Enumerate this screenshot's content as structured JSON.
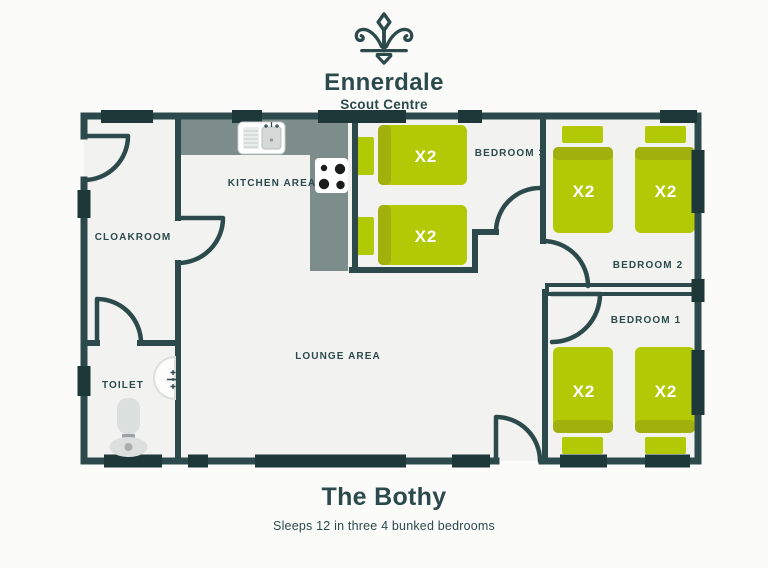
{
  "brand": {
    "name": "Ennerdale",
    "subtitle": "Scout Centre"
  },
  "plan": {
    "rooms": {
      "cloakroom": "CLOAKROOM",
      "kitchen": "KITCHEN AREA",
      "toilet": "TOILET",
      "lounge": "LOUNGE AREA",
      "bedroom3": "BEDROOM 3",
      "bedroom2": "BEDROOM 2",
      "bedroom1": "BEDROOM 1"
    },
    "bed_capacity_label": "X2",
    "colors": {
      "wall": "#2c4a4c",
      "window": "#1e3739",
      "bed": "#b2c905",
      "bed_band": "#a2b00d",
      "counter": "#7d8d8b",
      "floor": "#f2f3f0",
      "fixture": "#dbdfdd"
    }
  },
  "footer": {
    "title": "The Bothy",
    "subtitle": "Sleeps 12 in three 4 bunked bedrooms"
  }
}
